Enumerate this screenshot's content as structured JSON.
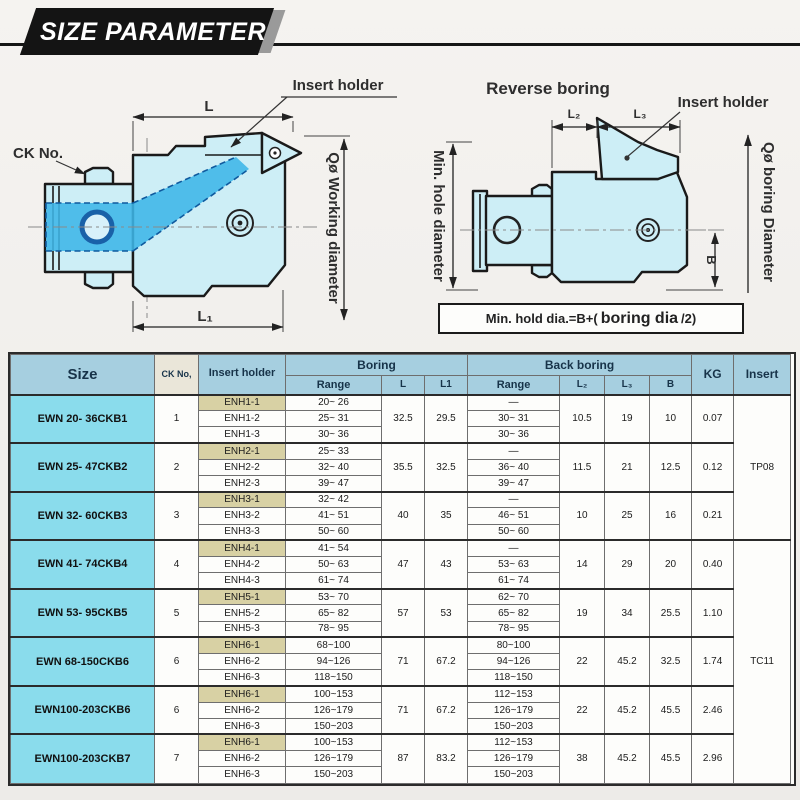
{
  "banner": {
    "title": "SIZE PARAMETER"
  },
  "colors": {
    "banner_black": "#141414",
    "header_blue": "#a6cfe0",
    "size_cyan": "#8adcec",
    "holder_tan": "#d8d1a4",
    "tool_fill": "#cdeef6",
    "highlight_blue": "#3eb6e8"
  },
  "diagram_left": {
    "labels": {
      "insert_holder": "Insert holder",
      "ck_no": "CK No.",
      "dim_l": "L",
      "dim_l1": "L₁",
      "working_diameter": "Qø Working diameter"
    }
  },
  "diagram_right": {
    "labels": {
      "title": "Reverse boring",
      "insert_holder": "Insert holder",
      "dim_l2": "L₂",
      "dim_l3": "L₃",
      "min_hole_diameter": "Min. hole diameter",
      "boring_diameter": "Qø boring Diameter",
      "dim_b": "B"
    },
    "formula": {
      "prefix": "Min. hold dia.=B+(",
      "mid": "boring dia",
      "suffix": "/2)"
    }
  },
  "table": {
    "headers": {
      "size": "Size",
      "ck_no": "CK No,",
      "insert_holder": "Insert holder",
      "boring": "Boring",
      "back_boring": "Back boring",
      "range": "Range",
      "l": "L",
      "l1": "L1",
      "l2": "L₂",
      "l3": "L₃",
      "b": "B",
      "kg": "KG",
      "insert": "Insert"
    },
    "insert_types": [
      {
        "label": "TP08",
        "start_group": 0,
        "span_groups": 3
      },
      {
        "label": "TC11",
        "start_group": 3,
        "span_groups": 5
      }
    ],
    "groups": [
      {
        "size": "EWN 20- 36CKB1",
        "ck_no": "1",
        "L": "32.5",
        "L1": "29.5",
        "L2": "10.5",
        "L3": "19",
        "B": "10",
        "KG": "0.07",
        "rows": [
          {
            "holder": "ENH1-1",
            "boring_range": "20~ 26",
            "back_range": "—"
          },
          {
            "holder": "ENH1-2",
            "boring_range": "25~ 31",
            "back_range": "30~ 31"
          },
          {
            "holder": "ENH1-3",
            "boring_range": "30~ 36",
            "back_range": "30~ 36"
          }
        ]
      },
      {
        "size": "EWN 25- 47CKB2",
        "ck_no": "2",
        "L": "35.5",
        "L1": "32.5",
        "L2": "11.5",
        "L3": "21",
        "B": "12.5",
        "KG": "0.12",
        "rows": [
          {
            "holder": "ENH2-1",
            "boring_range": "25~ 33",
            "back_range": "—"
          },
          {
            "holder": "ENH2-2",
            "boring_range": "32~ 40",
            "back_range": "36~ 40"
          },
          {
            "holder": "ENH2-3",
            "boring_range": "39~ 47",
            "back_range": "39~ 47"
          }
        ]
      },
      {
        "size": "EWN 32- 60CKB3",
        "ck_no": "3",
        "L": "40",
        "L1": "35",
        "L2": "10",
        "L3": "25",
        "B": "16",
        "KG": "0.21",
        "rows": [
          {
            "holder": "ENH3-1",
            "boring_range": "32~ 42",
            "back_range": "—"
          },
          {
            "holder": "ENH3-2",
            "boring_range": "41~ 51",
            "back_range": "46~ 51"
          },
          {
            "holder": "ENH3-3",
            "boring_range": "50~ 60",
            "back_range": "50~ 60"
          }
        ]
      },
      {
        "size": "EWN 41- 74CKB4",
        "ck_no": "4",
        "L": "47",
        "L1": "43",
        "L2": "14",
        "L3": "29",
        "B": "20",
        "KG": "0.40",
        "rows": [
          {
            "holder": "ENH4-1",
            "boring_range": "41~ 54",
            "back_range": "—"
          },
          {
            "holder": "ENH4-2",
            "boring_range": "50~ 63",
            "back_range": "53~ 63"
          },
          {
            "holder": "ENH4-3",
            "boring_range": "61~ 74",
            "back_range": "61~ 74"
          }
        ]
      },
      {
        "size": "EWN 53- 95CKB5",
        "ck_no": "5",
        "L": "57",
        "L1": "53",
        "L2": "19",
        "L3": "34",
        "B": "25.5",
        "KG": "1.10",
        "rows": [
          {
            "holder": "ENH5-1",
            "boring_range": "53~ 70",
            "back_range": "62~ 70"
          },
          {
            "holder": "ENH5-2",
            "boring_range": "65~ 82",
            "back_range": "65~ 82"
          },
          {
            "holder": "ENH5-3",
            "boring_range": "78~ 95",
            "back_range": "78~ 95"
          }
        ]
      },
      {
        "size": "EWN 68-150CKB6",
        "ck_no": "6",
        "L": "71",
        "L1": "67.2",
        "L2": "22",
        "L3": "45.2",
        "B": "32.5",
        "KG": "1.74",
        "rows": [
          {
            "holder": "ENH6-1",
            "boring_range": "68~100",
            "back_range": "80~100"
          },
          {
            "holder": "ENH6-2",
            "boring_range": "94~126",
            "back_range": "94~126"
          },
          {
            "holder": "ENH6-3",
            "boring_range": "118~150",
            "back_range": "118~150"
          }
        ]
      },
      {
        "size": "EWN100-203CKB6",
        "ck_no": "6",
        "L": "71",
        "L1": "67.2",
        "L2": "22",
        "L3": "45.2",
        "B": "45.5",
        "KG": "2.46",
        "rows": [
          {
            "holder": "ENH6-1",
            "boring_range": "100~153",
            "back_range": "112~153"
          },
          {
            "holder": "ENH6-2",
            "boring_range": "126~179",
            "back_range": "126~179"
          },
          {
            "holder": "ENH6-3",
            "boring_range": "150~203",
            "back_range": "150~203"
          }
        ]
      },
      {
        "size": "EWN100-203CKB7",
        "ck_no": "7",
        "L": "87",
        "L1": "83.2",
        "L2": "38",
        "L3": "45.2",
        "B": "45.5",
        "KG": "2.96",
        "rows": [
          {
            "holder": "ENH6-1",
            "boring_range": "100~153",
            "back_range": "112~153"
          },
          {
            "holder": "ENH6-2",
            "boring_range": "126~179",
            "back_range": "126~179"
          },
          {
            "holder": "ENH6-3",
            "boring_range": "150~203",
            "back_range": "150~203"
          }
        ]
      }
    ]
  }
}
